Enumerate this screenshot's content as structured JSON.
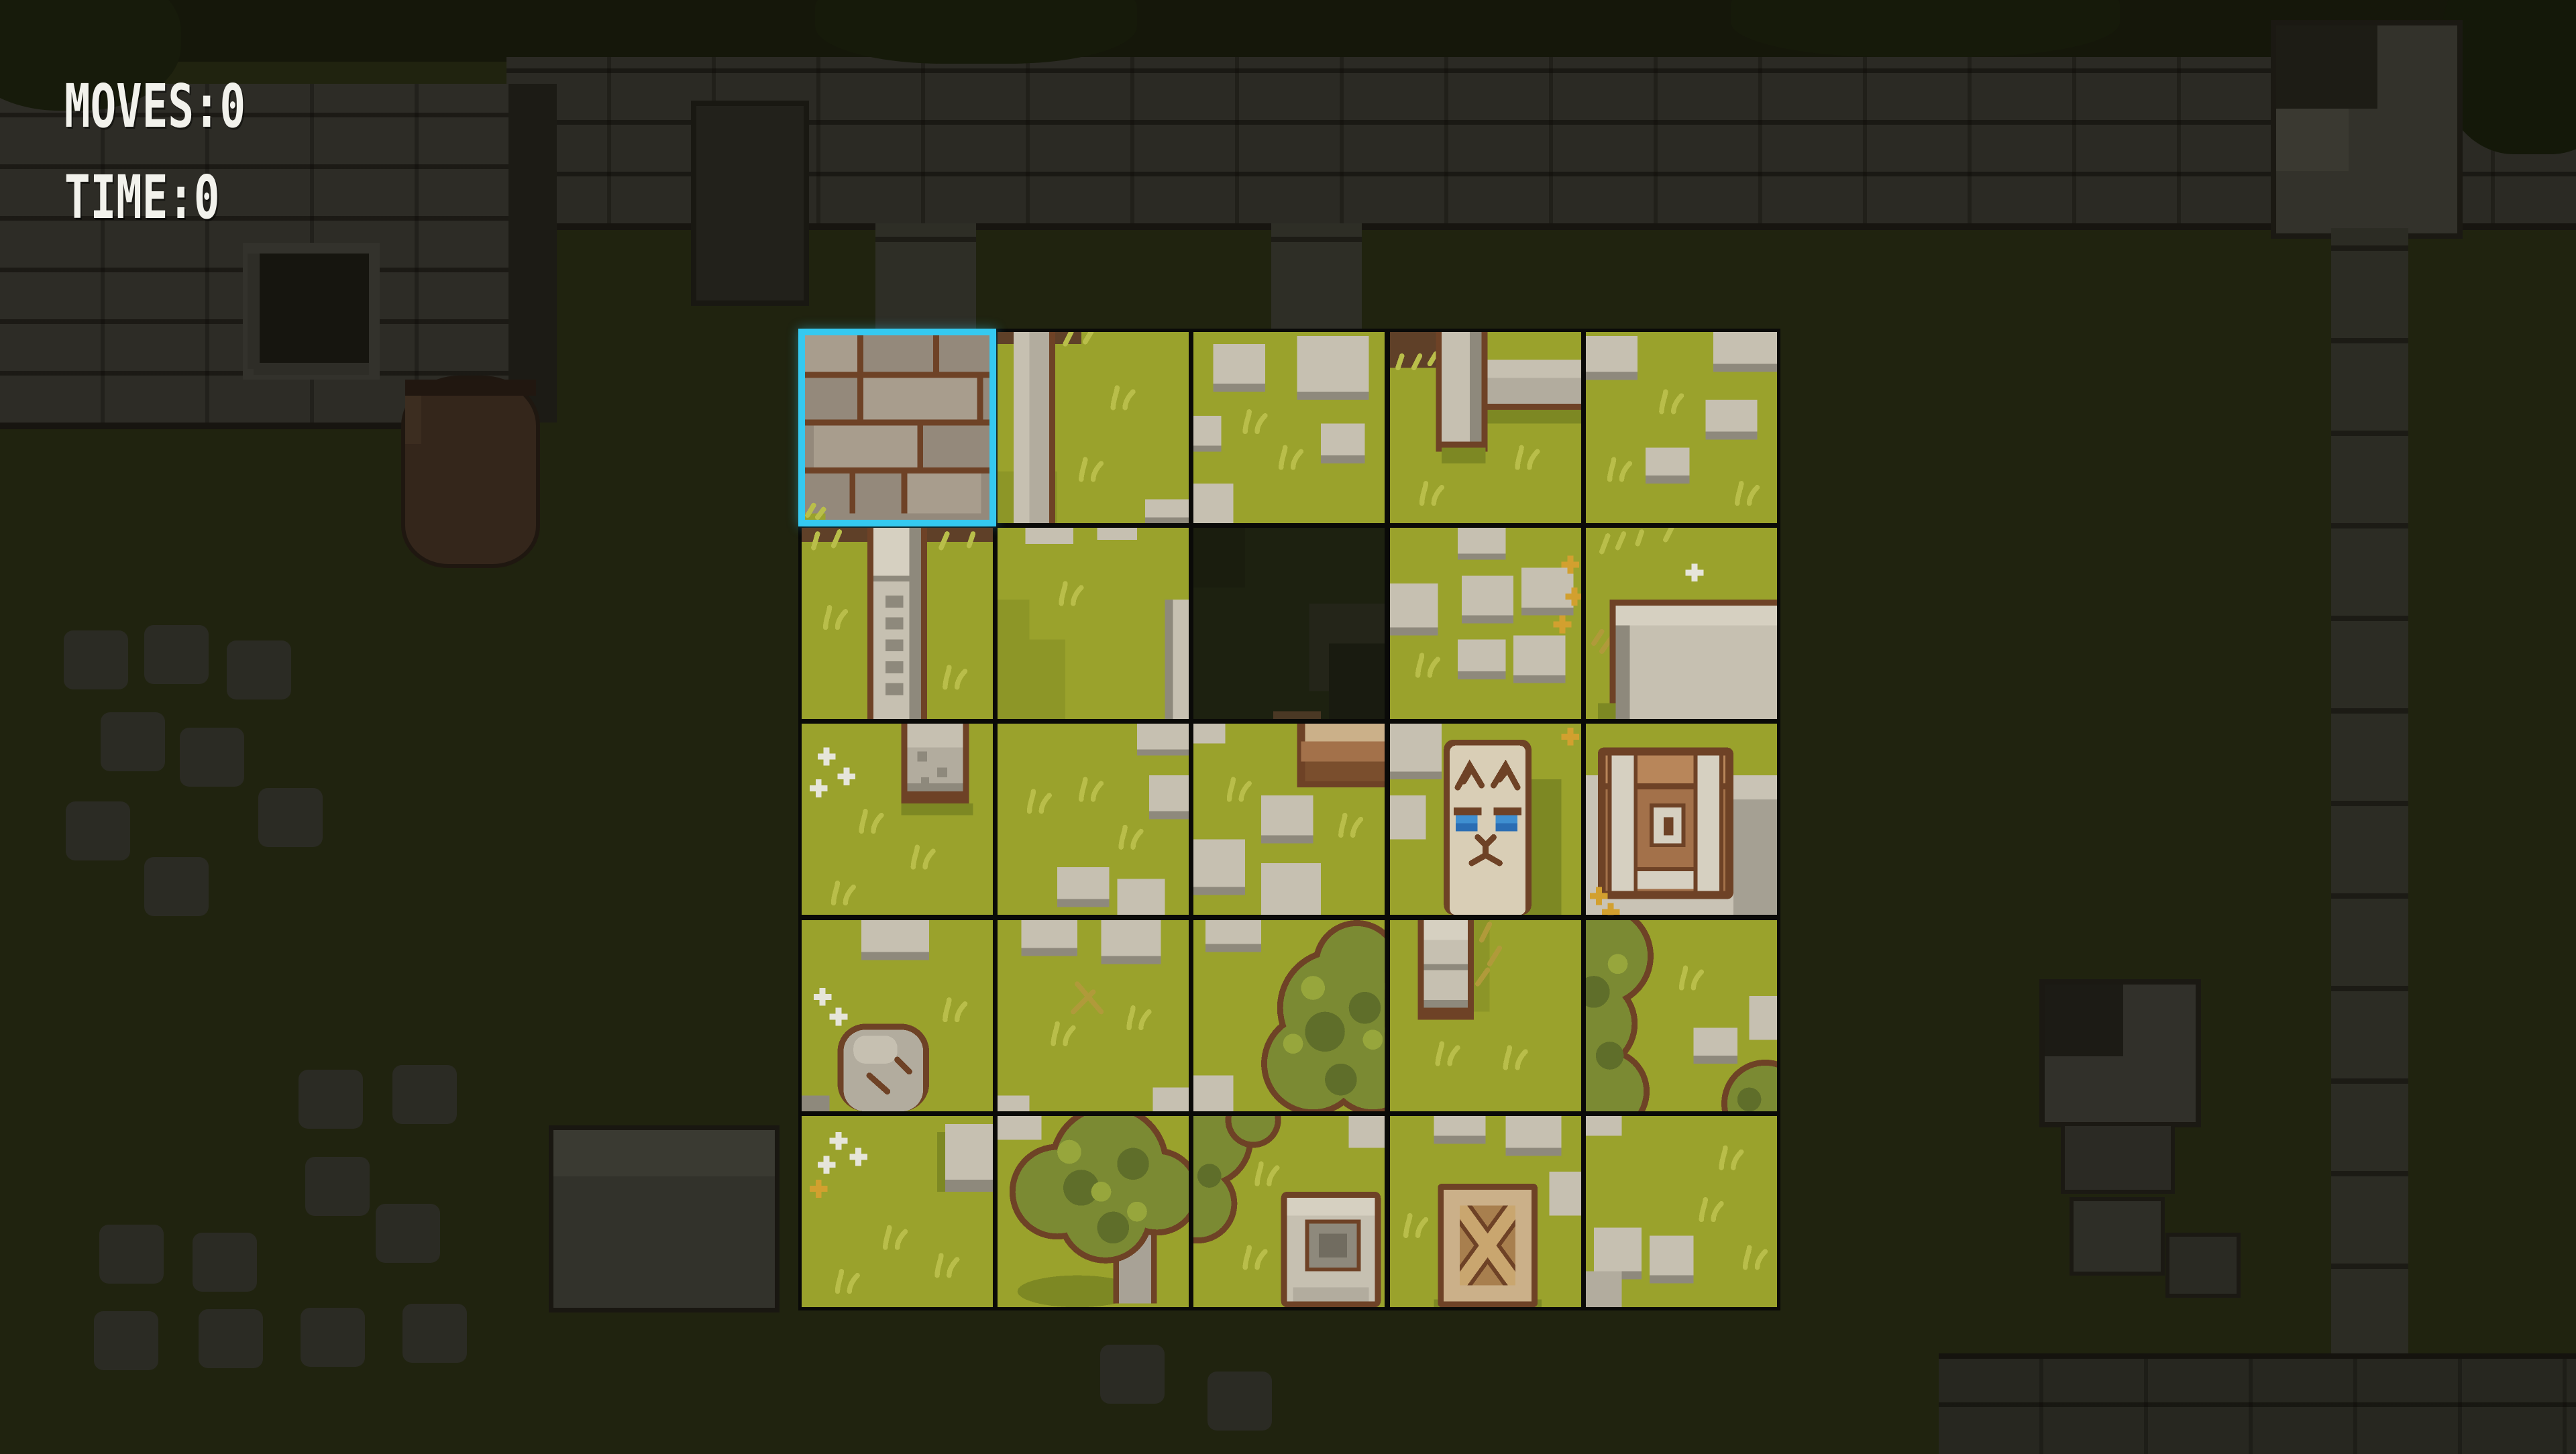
{
  "hud": {
    "moves_label": "MOVES:",
    "moves_value": "0",
    "time_label": "TIME:",
    "time_value": "0"
  },
  "puzzle": {
    "rows": 5,
    "cols": 5,
    "selected": {
      "row": 0,
      "col": 0
    },
    "empty": {
      "row": 1,
      "col": 2
    },
    "tiles": [
      {
        "row": 0,
        "col": 0,
        "art": "t00",
        "name": "stone-brick-wall",
        "selected": true
      },
      {
        "row": 0,
        "col": 1,
        "art": "t01",
        "name": "grass-wall-edge"
      },
      {
        "row": 0,
        "col": 2,
        "art": "t02",
        "name": "grass-stone-patches"
      },
      {
        "row": 0,
        "col": 3,
        "art": "t03",
        "name": "grass-post-and-ledge"
      },
      {
        "row": 0,
        "col": 4,
        "art": "t04",
        "name": "grass-stone-path"
      },
      {
        "row": 1,
        "col": 0,
        "art": "t10",
        "name": "grass-engraved-pillar"
      },
      {
        "row": 1,
        "col": 1,
        "art": "t11",
        "name": "grass-plain"
      },
      {
        "row": 1,
        "col": 2,
        "art": "t12",
        "name": "empty-slot",
        "empty": true
      },
      {
        "row": 1,
        "col": 3,
        "art": "t13",
        "name": "grass-path-crossing"
      },
      {
        "row": 1,
        "col": 4,
        "art": "t14",
        "name": "grass-stone-slab"
      },
      {
        "row": 2,
        "col": 0,
        "art": "t20",
        "name": "grass-pillar-base-flowers"
      },
      {
        "row": 2,
        "col": 1,
        "art": "t21",
        "name": "grass-scattered-stones"
      },
      {
        "row": 2,
        "col": 2,
        "art": "t22",
        "name": "grass-wooden-steps"
      },
      {
        "row": 2,
        "col": 3,
        "art": "t23",
        "name": "cat-statue"
      },
      {
        "row": 2,
        "col": 4,
        "art": "t24",
        "name": "treasure-chest"
      },
      {
        "row": 3,
        "col": 0,
        "art": "t30",
        "name": "grass-boulder"
      },
      {
        "row": 3,
        "col": 1,
        "art": "t31",
        "name": "grass-stones-twig"
      },
      {
        "row": 3,
        "col": 2,
        "art": "t32",
        "name": "grass-tree-right"
      },
      {
        "row": 3,
        "col": 3,
        "art": "t33",
        "name": "grass-post-top"
      },
      {
        "row": 3,
        "col": 4,
        "art": "t34",
        "name": "grass-tree-left"
      },
      {
        "row": 4,
        "col": 0,
        "art": "t40",
        "name": "grass-flowers"
      },
      {
        "row": 4,
        "col": 1,
        "art": "t41",
        "name": "tree"
      },
      {
        "row": 4,
        "col": 2,
        "art": "t42",
        "name": "grass-stone-monument"
      },
      {
        "row": 4,
        "col": 3,
        "art": "t43",
        "name": "wooden-crate"
      },
      {
        "row": 4,
        "col": 4,
        "art": "t44",
        "name": "grass-path-corner"
      }
    ]
  },
  "colors": {
    "selection": "#35c9f0",
    "hud_text": "#f2f2ec",
    "grid_line": "#0a0a08"
  }
}
